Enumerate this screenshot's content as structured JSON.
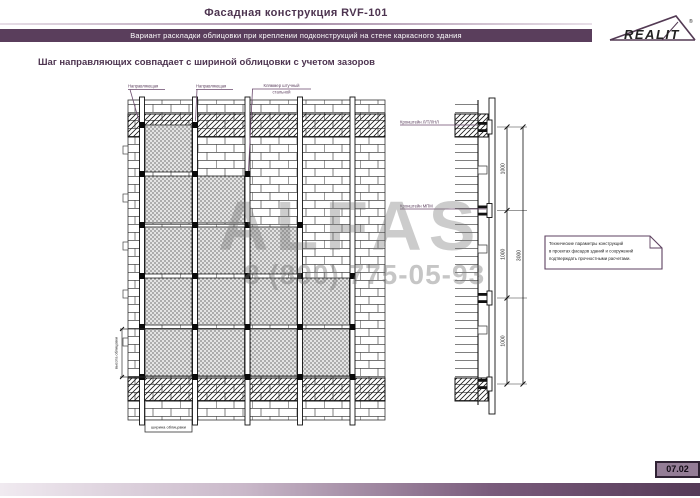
{
  "page": {
    "title": "Фасадная конструкция RVF-101",
    "subtitle": "Вариант раскладки облицовки при креплении подконструкций на стене каркасного здания",
    "heading": "Шаг направляющих совпадает с шириной облицовки с учетом зазоров",
    "page_number": "07.02"
  },
  "logo": {
    "brand": "REALIT",
    "registered": "®"
  },
  "drawing": {
    "callouts": {
      "rail_label": "Направляющая",
      "clamp_line1": "Кляммер штучный",
      "clamp_line2": "стальной",
      "bracket_top": "Кронштейн Л/ТЛ/НЛ",
      "bracket_mid": "Кронштейн МПМ"
    },
    "dim_height_label": "высота облицовки",
    "dim_width_label": "ширина облицовки",
    "dim_segment": "1000",
    "dim_total": "3000"
  },
  "note": {
    "line1": "Технические параметры конструкций",
    "line2": "в проектах фасадов зданий и сооружений",
    "line3": "подтверждать прочностными расчетами."
  },
  "watermark": {
    "brand": "ALFAS",
    "phone": "8 (800) 775-05-93"
  },
  "colors": {
    "accent": "#5a3e5c",
    "badge_bg": "#947d96",
    "watermark_gray": "#787878"
  }
}
